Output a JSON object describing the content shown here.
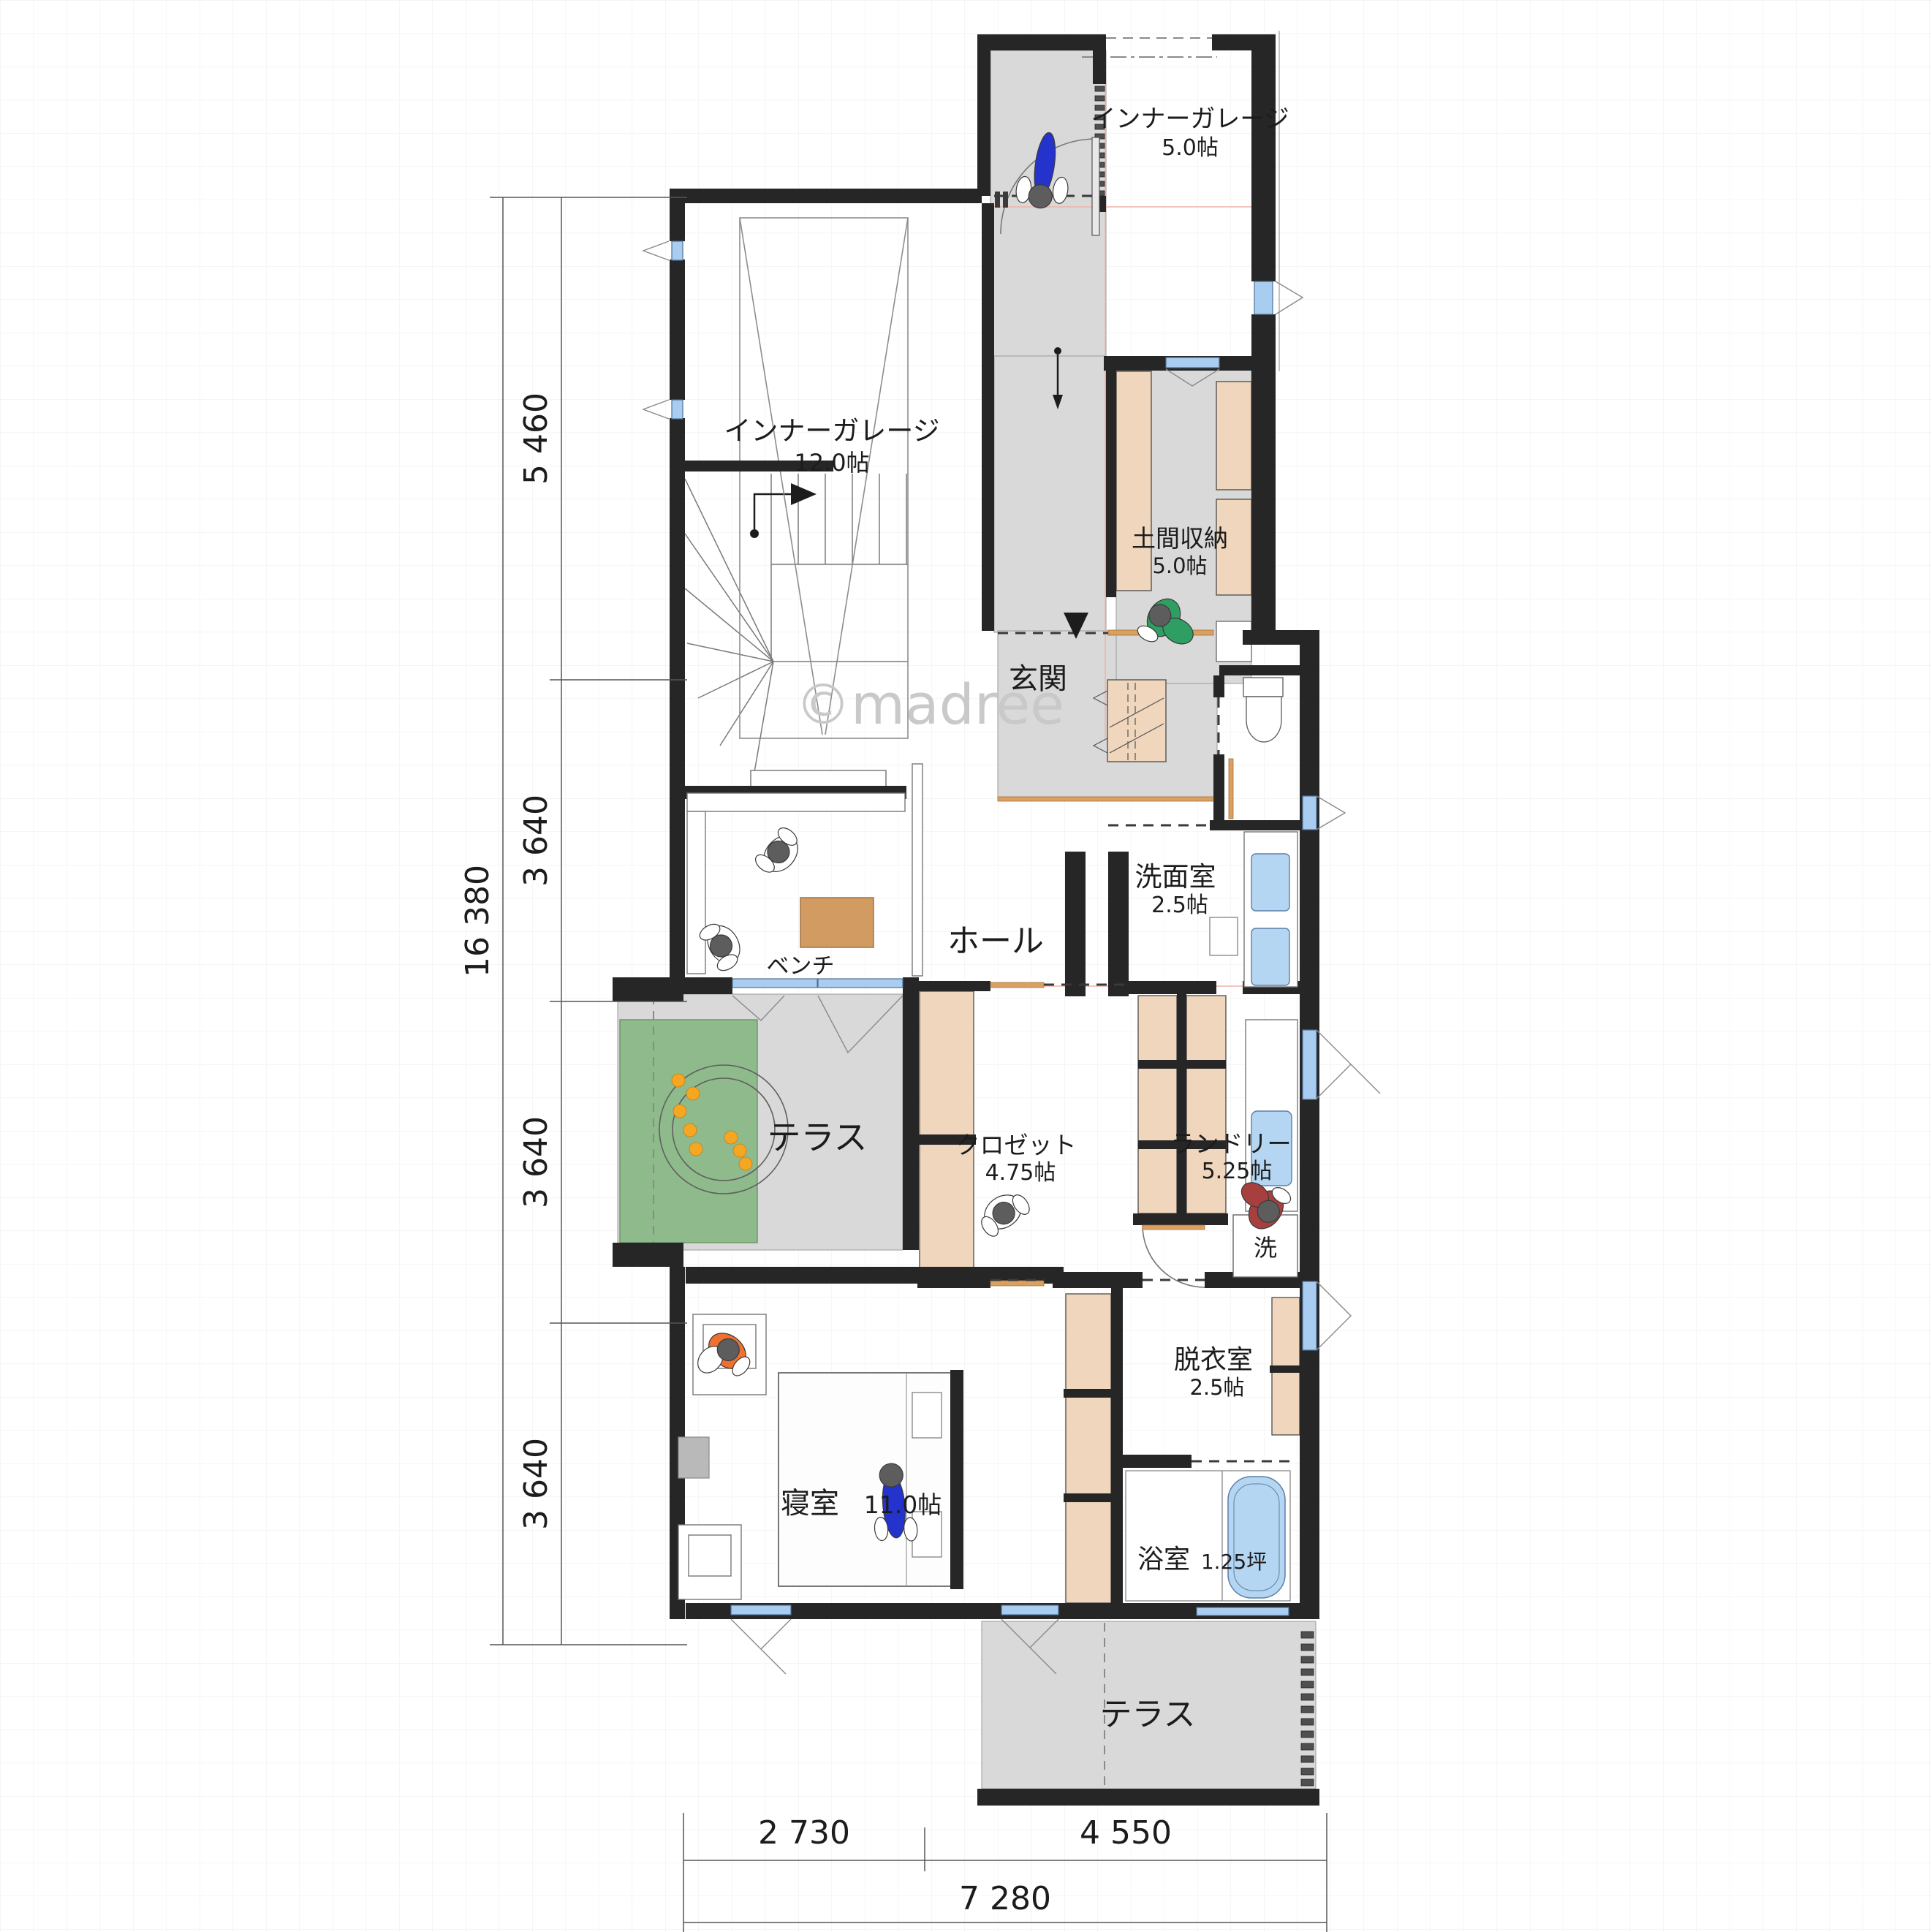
{
  "title": "1F floor plan",
  "watermark": "©madree",
  "t": {
    "garage5_name": "インナーガレージ",
    "garage5_size": "5.0帖",
    "garage12_name": "インナーガレージ",
    "garage12_size": "12.0帖",
    "doma_name": "土間収納",
    "doma_size": "5.0帖",
    "genkan": "玄関",
    "hall": "ホール",
    "bench": "ベンチ",
    "washroom_name": "洗面室",
    "washroom_size": "2.5帖",
    "terrace_mid": "テラス",
    "closet_name": "クロゼット",
    "closet_size": "4.75帖",
    "laundry_name": "ランドリー",
    "laundry_size": "5.25帖",
    "washer": "洗",
    "dressing_name": "脱衣室",
    "dressing_size": "2.5帖",
    "bedroom_name": "寝室",
    "bedroom_size": "11.0帖",
    "bath_name": "浴室",
    "bath_size": "1.25坪",
    "terrace_bottom": "テラス",
    "watermark": "©madree"
  },
  "rooms": [
    {
      "name": "インナーガレージ",
      "size": "5.0帖",
      "floor": "concrete"
    },
    {
      "name": "インナーガレージ",
      "size": "12.0帖",
      "floor": "concrete"
    },
    {
      "name": "土間収納",
      "size": "5.0帖",
      "floor": "doma"
    },
    {
      "name": "玄関",
      "size": "",
      "floor": "doma"
    },
    {
      "name": "ホール",
      "size": "",
      "floor": "wood"
    },
    {
      "name": "ベンチ",
      "size": "",
      "floor": "wood"
    },
    {
      "name": "洗面室",
      "size": "2.5帖",
      "floor": "wood"
    },
    {
      "name": "テラス",
      "size": "",
      "floor": "deck"
    },
    {
      "name": "クロゼット",
      "size": "4.75帖",
      "floor": "wood"
    },
    {
      "name": "ランドリー",
      "size": "5.25帖",
      "floor": "wood"
    },
    {
      "name": "脱衣室",
      "size": "2.5帖",
      "floor": "wood"
    },
    {
      "name": "寝室",
      "size": "11.0帖",
      "floor": "wood"
    },
    {
      "name": "浴室",
      "size": "1.25坪",
      "floor": "bath"
    },
    {
      "name": "テラス",
      "size": "",
      "floor": "deck"
    }
  ],
  "dims": {
    "left_total": "16 380",
    "left_1": "5 460",
    "left_2": "3 640",
    "left_3": "3 640",
    "left_4": "3 640",
    "bottom_1": "2 730",
    "bottom_2": "4 550",
    "bottom_total": "7 280"
  },
  "colors": {
    "wall": "#262626",
    "outdoor_floor": "#d9d9d9",
    "cabinet": "#efd6bd",
    "window": "#a9cdf0",
    "water": "#b5d6f2",
    "mat_green": "#8fba8c",
    "door_track": "#d9a05f",
    "person_blue": "#2433cc",
    "person_green": "#2f9e62",
    "person_red": "#a83f3f",
    "person_orange": "#f07030",
    "table_wood": "#d29b62"
  }
}
